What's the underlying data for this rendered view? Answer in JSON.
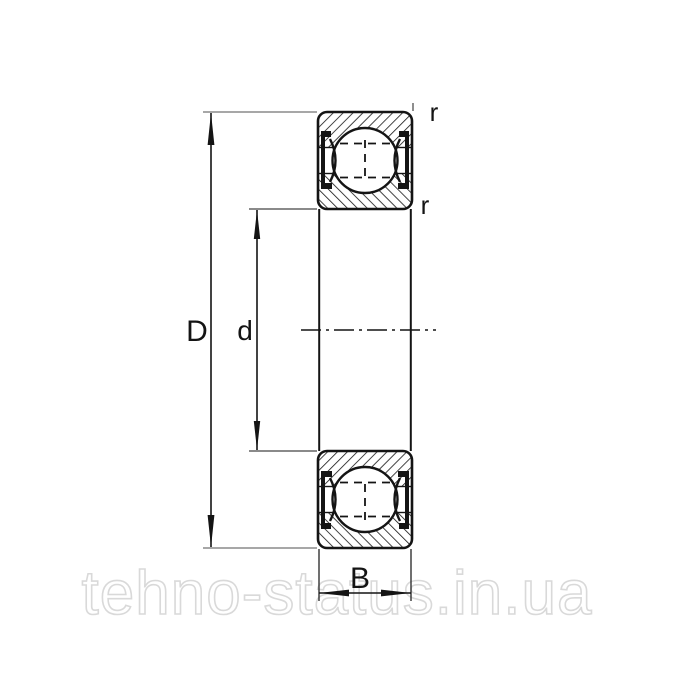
{
  "page": {
    "background": "#ffffff"
  },
  "drawing": {
    "labels": {
      "outer_diameter": "D",
      "bore_diameter": "d",
      "width": "B",
      "corner_radius_top": "r",
      "corner_radius_bore": "r"
    },
    "watermark": {
      "text": "tehno-status.in.ua"
    },
    "colors": {
      "line": "#141414",
      "extension_line": "#8a8a8a",
      "watermark_outline": "#d9d9d9"
    }
  }
}
